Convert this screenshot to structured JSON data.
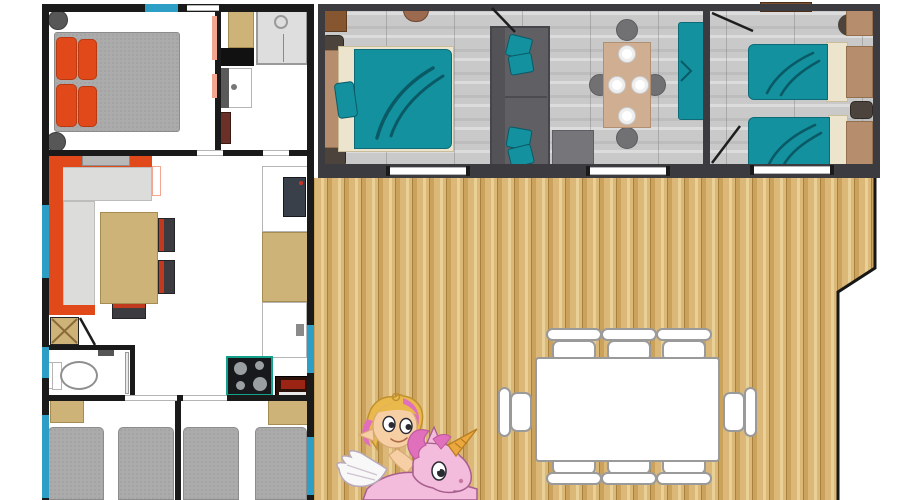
{
  "meta": {
    "description": "Top-down 3D floor plan of a holiday mobile home with two sleeping units and a large wooden terrace, with a cartoon mascot",
    "visible_text": "none"
  },
  "colors": {
    "bg": "#ffffff",
    "wall": "#1a1a1a",
    "wallDark": "#3b3b40",
    "window": "#2d9fc6",
    "orange": "#e2491a",
    "orangeDark": "#b93a10",
    "mattress": "#ababab",
    "mattressLine": "#8c8c8c",
    "tan": "#cdb377",
    "tanDark": "#a58d52",
    "cream": "#ece4cc",
    "headboard": "#b78e6d",
    "teal": "#13919f",
    "tealDark": "#0a5a66",
    "sofaGray": "#5f5f64",
    "cushion": "#dcdcda",
    "chairDark": "#3c3c40",
    "chairRed": "#c03a20",
    "tableTan": "#cfae92",
    "chairGray": "#717174",
    "stool": "#575757",
    "stoolBrown": "#4c443c",
    "brown": "#85562f",
    "floorGrayA": "#c9c9c9",
    "deckA": "#dcb878",
    "deckB": "#caa25c",
    "deckC": "#e9d096",
    "deckSeam": "#a8813e",
    "shower": "#dedede",
    "applianceDark": "#3a4049",
    "stoveDark": "#17191d",
    "stoveTeal": "#12a28c",
    "burner": "#9aa0a2",
    "ovenBrown": "#2a120a",
    "ovenRed": "#9c2414",
    "salmon": "#f2a58f",
    "skin": "#f6d0a4",
    "hairBlond": "#e9b94b",
    "hairPink": "#e070bc",
    "unicorn": "#f4bcdc",
    "unicornLine": "#a75f8e",
    "wing": "#f8f8f8",
    "horn": "#eaa83e",
    "eyeDark": "#2a2a33"
  },
  "floorplan": {
    "left_unit": {
      "floor": "white",
      "rooms": {
        "master_bedroom": "master bedroom: double bed with grey mattress, orange pillows, two round bedside stools",
        "shower_room": "shower room: shower cabin, washbasin, wardrobe, cabinet",
        "living_room": "living room: orange L-shaped sofa with grey cushions, dining table with three dark chairs",
        "wc": "WC: toilet and small washbasin",
        "kitchen": "kitchen: fridge, worktop, sink, hob with four burners, oven",
        "kids_bedroom_left": "bedroom: two single beds with grey mattresses and bedside cabinet",
        "kids_bedroom_right": "bedroom: two single beds with grey mattresses and side cabinet"
      }
    },
    "right_unit": {
      "floor": "grey wood planks",
      "rooms": {
        "teal_double_bedroom": "bedroom: double bed with teal cover, side cabinet and stools",
        "lounge": "lounge: grey sofa with teal cushions, coffee table, dining table with four plates and four round stools, teal bench",
        "teal_twin_bedroom": "bedroom: two single beds with teal covers, bedside table, dresser"
      }
    },
    "terrace": {
      "floor": "wooden deck planks with stepped right edge",
      "furniture": "white rectangular dining table with eight white chairs"
    },
    "mascot": "cartoon girl with blonde and pink hair riding a pink winged unicorn with a golden horn"
  }
}
